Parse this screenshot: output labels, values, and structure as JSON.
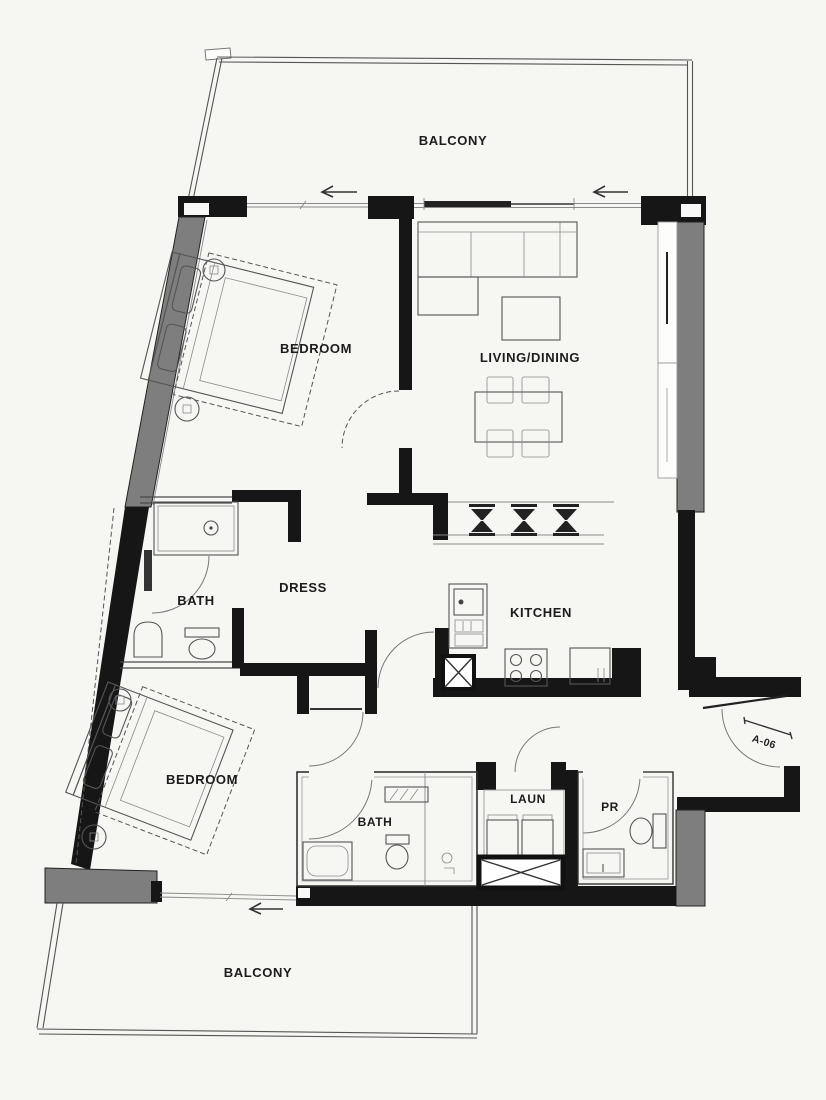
{
  "floor_plan": {
    "unit_tag": "A-06",
    "labels": {
      "balcony_top": "BALCONY",
      "bedroom_top": "BEDROOM",
      "living_dining": "LIVING/DINING",
      "bath_top": "BATH",
      "dress": "DRESS",
      "kitchen": "KITCHEN",
      "bedroom_bottom": "BEDROOM",
      "bath_bottom": "BATH",
      "laundry": "LAUN",
      "powder_room": "PR",
      "balcony_bottom": "BALCONY"
    },
    "colors": {
      "background": "#f6f6f3",
      "wall_black": "#161616",
      "shear_wall_gray": "#7e7e7e",
      "thin_line": "#4a4a4a"
    }
  }
}
